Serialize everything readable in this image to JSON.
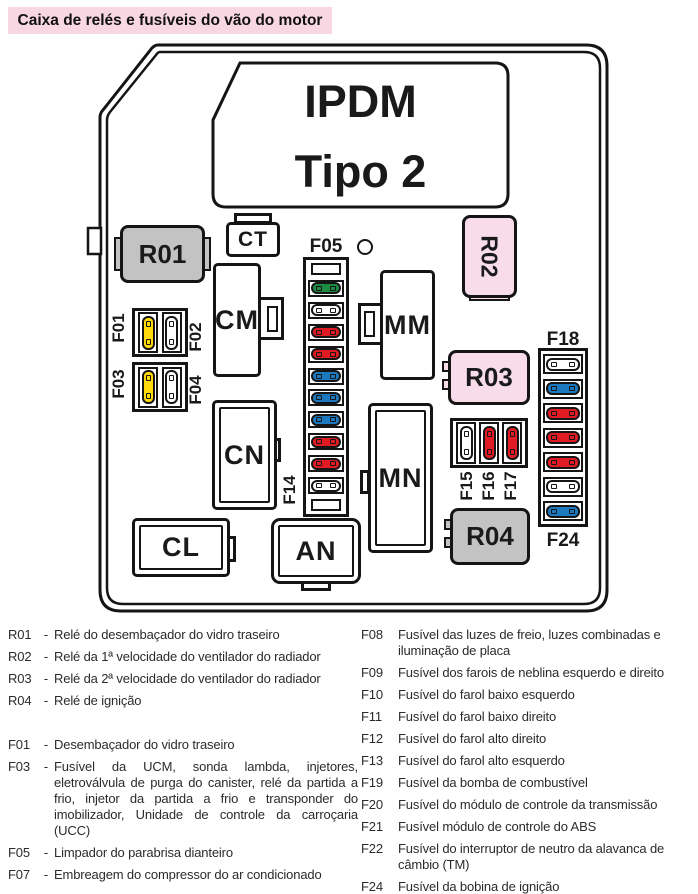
{
  "title": {
    "text": "Caixa de relés e fusíveis do vão do motor",
    "bg": "#f8d7e3"
  },
  "diagram": {
    "box_label": {
      "line1": "IPDM",
      "line2": "Tipo 2"
    },
    "relays": {
      "r01": {
        "label": "R01",
        "color": "#c3c3c3"
      },
      "r02": {
        "label": "R02",
        "color": "#f9dcea"
      },
      "r03": {
        "label": "R03",
        "color": "#f9dcea"
      },
      "r04": {
        "label": "R04",
        "color": "#c3c3c3"
      }
    },
    "connectors": {
      "ct": "CT",
      "cm": "CM",
      "mm": "MM",
      "cn": "CN",
      "mn": "MN",
      "an": "AN",
      "cl": "CL"
    },
    "fuse_colors": {
      "yellow": "#ffd908",
      "white": "#ffffff",
      "red": "#e11b23",
      "blue": "#1c79bd",
      "green": "#1d8a42"
    },
    "fuse_groups": {
      "f01_f02": {
        "left_label": "F01",
        "right_label": "F02",
        "fuses": [
          "yellow",
          "white"
        ]
      },
      "f03_f04": {
        "left_label": "F03",
        "right_label": "F04",
        "fuses": [
          "yellow",
          "white"
        ]
      },
      "f05_f14": {
        "top_label": "F05",
        "bottom_label": "F14",
        "fuses": [
          "green",
          "white",
          "red",
          "red",
          "blue",
          "blue",
          "blue",
          "red",
          "red",
          "white"
        ]
      },
      "f15_f17": {
        "labels": [
          "F15",
          "F16",
          "F17"
        ],
        "fuses": [
          "white",
          "red",
          "red"
        ]
      },
      "f18_f24": {
        "top_label": "F18",
        "bottom_label": "F24",
        "fuses": [
          "white",
          "blue",
          "red",
          "red",
          "red",
          "white",
          "blue"
        ]
      }
    }
  },
  "legend": {
    "left": [
      {
        "code": "R01",
        "sep": "-",
        "text": "Relé do desembaçador do vidro traseiro"
      },
      {
        "code": "R02",
        "sep": "-",
        "text": "Relé da 1ª velocidade do ventilador do radiador"
      },
      {
        "code": "R03",
        "sep": "-",
        "text": "Relé da 2ª velocidade do ventilador do radiador"
      },
      {
        "code": "R04",
        "sep": "-",
        "text": "Relé de ignição"
      },
      {
        "code": "F01",
        "sep": "-",
        "text": "Desembaçador do vidro traseiro"
      },
      {
        "code": "F03",
        "sep": "-",
        "text": "Fusível da UCM, sonda lambda, injetores, eletroválvula de purga do canister, relé da partida a frio, injetor da partida a frio e transponder do imobilizador, Unidade de controle da carroçaria (UCC)"
      },
      {
        "code": "F05",
        "sep": "-",
        "text": "Limpador do parabrisa dianteiro"
      },
      {
        "code": "F07",
        "sep": "-",
        "text": "Embreagem do compressor do ar condicionado"
      }
    ],
    "right": [
      {
        "code": "F08",
        "text": "Fusível das luzes de freio, luzes combinadas e iluminação de placa"
      },
      {
        "code": "F09",
        "text": "Fusível dos farois de neblina esquerdo e direito"
      },
      {
        "code": "F10",
        "text": "Fusível do farol baixo esquerdo"
      },
      {
        "code": "F11",
        "text": "Fusível do farol baixo direito"
      },
      {
        "code": "F12",
        "text": "Fusível do farol alto direito"
      },
      {
        "code": "F13",
        "text": "Fusível do farol alto esquerdo"
      },
      {
        "code": "F19",
        "text": "Fusível da bomba de combustível"
      },
      {
        "code": "F20",
        "text": "Fusível do módulo de controle da transmissão"
      },
      {
        "code": "F21",
        "text": "Fusível módulo de controle do ABS"
      },
      {
        "code": "F22",
        "text": "Fusível do interruptor de neutro da alavanca de câmbio (TM)"
      },
      {
        "code": "F24",
        "text": "Fusível da bobina de ignição"
      }
    ]
  }
}
